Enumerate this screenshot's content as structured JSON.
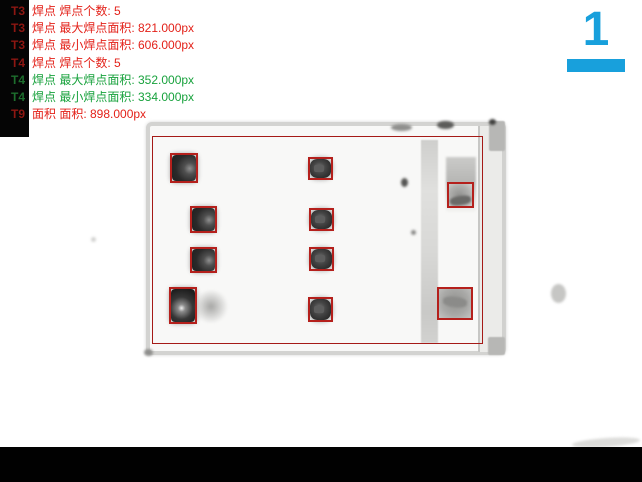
{
  "overlay": {
    "annotations": [
      {
        "tag": "T3",
        "text": "焊点 焊点个数: 5",
        "status": "fail"
      },
      {
        "tag": "T3",
        "text": "焊点 最大焊点面积: 821.000px",
        "status": "fail"
      },
      {
        "tag": "T3",
        "text": "焊点 最小焊点面积: 606.000px",
        "status": "fail"
      },
      {
        "tag": "T4",
        "text": "焊点 焊点个数: 5",
        "status": "fail"
      },
      {
        "tag": "T4",
        "text": "焊点 最大焊点面积: 352.000px",
        "status": "pass"
      },
      {
        "tag": "T4",
        "text": "焊点 最小焊点面积: 334.000px",
        "status": "pass"
      },
      {
        "tag": "T9",
        "text": "面积 面积: 898.000px",
        "status": "fail"
      }
    ]
  },
  "inspection_summary": {
    "T3": {
      "feature": "焊点",
      "count": 5,
      "max_area_px": 821.0,
      "min_area_px": 606.0
    },
    "T4": {
      "feature": "焊点",
      "count": 5,
      "max_area_px": 352.0,
      "min_area_px": 334.0
    },
    "T9": {
      "feature": "面积",
      "area_px": 898.0
    }
  },
  "page_indicator": {
    "number": "1"
  },
  "detections": {
    "solder_joint_boxes": 10,
    "component_outline_boxes": 1
  },
  "colors": {
    "fail_text": "#e32119",
    "fail_tag": "#8d1712",
    "pass_text": "#18a23d",
    "pass_tag": "#1d6e2d",
    "indicator": "#18a0dc",
    "detection_box": "#b5201c",
    "outline_box": "#a51a17"
  }
}
